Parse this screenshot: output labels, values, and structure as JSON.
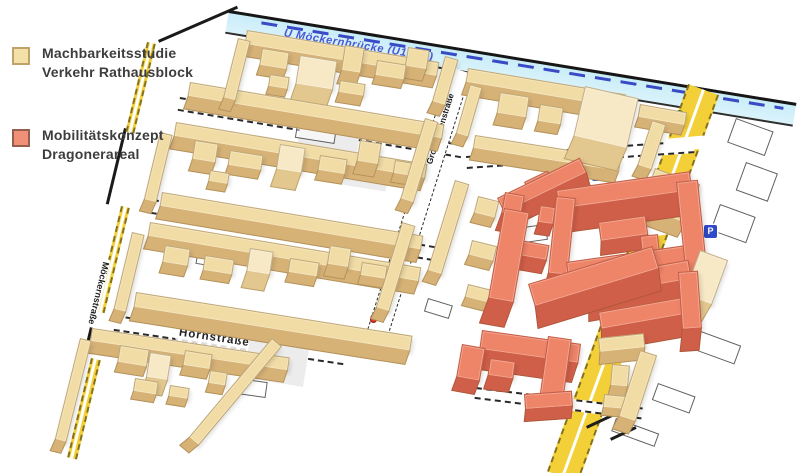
{
  "legend": {
    "items": [
      {
        "swatch_fill": "#f2e2a8",
        "swatch_border": "#c0a36a",
        "lines": [
          "Machbarkeitsstudie",
          "Verkehr Rathausblock"
        ]
      },
      {
        "swatch_fill": "#f09077",
        "swatch_border": "#93604f",
        "lines": [
          "Mobilitätskonzept",
          "Dragonerareal"
        ]
      }
    ]
  },
  "colors": {
    "beige_top": "#f1dca6",
    "beige_side": "#d7b277",
    "beige_light_top": "#f7e9c6",
    "beige_light_side": "#e2c88e",
    "salmon_top": "#ee8468",
    "salmon_side": "#d05f49",
    "canal": "#c9edf8",
    "road_yellow": "#f4d038",
    "ubahn_blue": "#4a57d4",
    "parking_blue": "#2f49c9"
  },
  "map": {
    "canal": {
      "x": 229,
      "y": 10,
      "w": 575,
      "h": 24,
      "r": 9.3,
      "label": "U Möckernbrücke (U1, U3)"
    },
    "edges": [
      {
        "x": 158,
        "y": 40,
        "w": 86,
        "h": 3,
        "r": -23.5
      },
      {
        "x": 124,
        "y": 128,
        "w": 3,
        "h": 78,
        "r": 13.5
      },
      {
        "x": 94,
        "y": 310,
        "w": 3,
        "h": 52,
        "r": 13.5
      }
    ],
    "yellow_roads": [
      {
        "id": "mehringdamm",
        "x": 688,
        "y": 84,
        "w": 33,
        "h": 412,
        "r": 20,
        "label": "Mehringdamm",
        "label_top": 195,
        "label_size": 11
      },
      {
        "id": "moeckernstrasse-n",
        "x": 147,
        "y": 42,
        "w": 9,
        "h": 92,
        "r": 13.5
      },
      {
        "id": "moeckernstrasse-m",
        "x": 121,
        "y": 206,
        "w": 9,
        "h": 108,
        "r": 13.5
      },
      {
        "id": "moeckernstrasse-s",
        "x": 91,
        "y": 358,
        "w": 10,
        "h": 102,
        "r": 13.5
      }
    ],
    "white_roads": [
      {
        "id": "cross-street-1",
        "x": 180,
        "y": 97,
        "w": 287,
        "h": 14,
        "r": 9.5
      },
      {
        "id": "cross-street-2",
        "x": 153,
        "y": 199,
        "w": 296,
        "h": 15,
        "r": 9.5
      },
      {
        "id": "hornstrasse",
        "x": 116,
        "y": 315,
        "w": 232,
        "h": 16,
        "r": 8.5,
        "label": "Hornstraße",
        "label_left": 62,
        "label_size": 11.5
      },
      {
        "id": "obentrautstrasse",
        "x": 466,
        "y": 156,
        "w": 228,
        "h": 13,
        "r": -4
      },
      {
        "id": "south-street",
        "x": 476,
        "y": 387,
        "w": 168,
        "h": 12,
        "r": 7
      },
      {
        "id": "grossbeerenstrasse",
        "x": 450,
        "y": 67,
        "w": 22,
        "h": 300,
        "r": 17.5,
        "vertical": true,
        "vlabels": [
          {
            "label": "Großbeerenstraße",
            "top": 22,
            "size": 8.5
          },
          {
            "label": "Großbeerenstraße",
            "top": 178,
            "size": 8.5
          }
        ]
      }
    ],
    "vlabels": [
      {
        "id": "moeckernstrasse-label",
        "x": 102,
        "y": 258,
        "r": 13.5,
        "label": "Möckernstraße",
        "size": 9
      }
    ],
    "patches": [
      {
        "kind": "patch",
        "x": 664,
        "y": 139,
        "w": 40,
        "h": 13,
        "r": -5
      },
      {
        "kind": "patch",
        "x": 606,
        "y": 294,
        "w": 40,
        "h": 12,
        "r": -10
      },
      {
        "kind": "patch",
        "x": 634,
        "y": 228,
        "w": 36,
        "h": 11,
        "r": -8
      },
      {
        "kind": "gpatch",
        "x": 300,
        "y": 128,
        "w": 60,
        "h": 30,
        "r": 9
      },
      {
        "kind": "gpatch",
        "x": 340,
        "y": 160,
        "w": 50,
        "h": 24,
        "r": 9
      },
      {
        "kind": "gpatch",
        "x": 250,
        "y": 338,
        "w": 60,
        "h": 40,
        "r": 9
      },
      {
        "kind": "gpatch",
        "x": 598,
        "y": 200,
        "w": 40,
        "h": 20,
        "r": -8
      },
      {
        "kind": "green-patch",
        "x": 332,
        "y": 111,
        "w": 14,
        "h": 9,
        "r": 9
      }
    ],
    "footprints": [
      {
        "x": 736,
        "y": 118,
        "w": 40,
        "h": 26,
        "r": 20
      },
      {
        "x": 746,
        "y": 162,
        "w": 34,
        "h": 30,
        "r": 20
      },
      {
        "x": 720,
        "y": 204,
        "w": 38,
        "h": 28,
        "r": 20
      },
      {
        "x": 698,
        "y": 330,
        "w": 46,
        "h": 20,
        "r": 20
      },
      {
        "x": 658,
        "y": 383,
        "w": 40,
        "h": 18,
        "r": 20
      },
      {
        "x": 616,
        "y": 418,
        "w": 46,
        "h": 14,
        "r": 20
      },
      {
        "x": 298,
        "y": 118,
        "w": 40,
        "h": 20,
        "r": 9
      },
      {
        "x": 348,
        "y": 228,
        "w": 36,
        "h": 18,
        "r": 9
      },
      {
        "x": 198,
        "y": 248,
        "w": 30,
        "h": 16,
        "r": 9
      },
      {
        "x": 516,
        "y": 228,
        "w": 30,
        "h": 16,
        "r": -8
      },
      {
        "x": 588,
        "y": 298,
        "w": 28,
        "h": 14,
        "r": -8
      },
      {
        "x": 238,
        "y": 378,
        "w": 30,
        "h": 16,
        "r": 8
      },
      {
        "x": 428,
        "y": 298,
        "w": 26,
        "h": 14,
        "r": 17
      },
      {
        "x": 652,
        "y": 298,
        "w": 30,
        "h": 16,
        "r": -8
      }
    ],
    "fp_lines": [
      {
        "x": 586,
        "y": 426,
        "w": 30,
        "h": 3,
        "r": -25
      },
      {
        "x": 610,
        "y": 438,
        "w": 28,
        "h": 3,
        "r": -25
      }
    ],
    "markers": [
      {
        "type": "p",
        "x": 592,
        "y": 168,
        "label": "P"
      },
      {
        "type": "p",
        "x": 704,
        "y": 225,
        "label": "P"
      },
      {
        "type": "green-dot",
        "x": 675,
        "y": 110
      },
      {
        "type": "red-dot",
        "x": 370,
        "y": 314
      },
      {
        "type": "blue-dot",
        "x": 560,
        "y": 290
      }
    ],
    "buildings": [
      [
        247,
        30,
        195,
        15,
        12,
        9.5,
        "b"
      ],
      [
        238,
        38,
        13,
        62,
        12,
        14,
        "b"
      ],
      [
        190,
        82,
        258,
        15,
        13,
        9.5,
        "b"
      ],
      [
        445,
        56,
        14,
        48,
        12,
        16,
        "b"
      ],
      [
        262,
        48,
        28,
        18,
        10,
        9,
        "b"
      ],
      [
        300,
        55,
        38,
        30,
        22,
        9,
        "bl"
      ],
      [
        345,
        45,
        20,
        26,
        14,
        9,
        "b"
      ],
      [
        377,
        60,
        30,
        16,
        9,
        9,
        "b"
      ],
      [
        408,
        47,
        22,
        20,
        12,
        9,
        "b"
      ],
      [
        270,
        74,
        20,
        13,
        8,
        9,
        "b"
      ],
      [
        340,
        80,
        26,
        13,
        10,
        9,
        "b"
      ],
      [
        468,
        68,
        160,
        15,
        13,
        9.5,
        "b"
      ],
      [
        475,
        135,
        148,
        14,
        12,
        9,
        "b"
      ],
      [
        470,
        84,
        13,
        52,
        11,
        16,
        "b"
      ],
      [
        585,
        86,
        55,
        52,
        24,
        13,
        "bl"
      ],
      [
        500,
        92,
        30,
        22,
        12,
        9,
        "b"
      ],
      [
        540,
        104,
        24,
        18,
        10,
        9,
        "b"
      ],
      [
        640,
        104,
        48,
        14,
        10,
        10,
        "b"
      ],
      [
        652,
        120,
        15,
        48,
        12,
        18,
        "b"
      ],
      [
        655,
        168,
        48,
        42,
        16,
        20,
        "b"
      ],
      [
        176,
        122,
        255,
        15,
        13,
        9.5,
        "b"
      ],
      [
        160,
        132,
        13,
        70,
        12,
        13.5,
        "b"
      ],
      [
        162,
        192,
        265,
        15,
        13,
        9.5,
        "b"
      ],
      [
        425,
        118,
        14,
        85,
        12,
        17,
        "b"
      ],
      [
        195,
        140,
        24,
        20,
        12,
        9,
        "b"
      ],
      [
        230,
        150,
        34,
        16,
        9,
        9,
        "b"
      ],
      [
        280,
        144,
        26,
        26,
        18,
        9,
        "bl"
      ],
      [
        320,
        155,
        28,
        16,
        10,
        9,
        "b"
      ],
      [
        360,
        140,
        22,
        22,
        13,
        9,
        "b"
      ],
      [
        395,
        160,
        24,
        14,
        9,
        9,
        "b"
      ],
      [
        210,
        170,
        20,
        12,
        8,
        9,
        "b"
      ],
      [
        455,
        180,
        15,
        95,
        12,
        17,
        "b"
      ],
      [
        478,
        196,
        22,
        18,
        10,
        14,
        "b"
      ],
      [
        472,
        240,
        26,
        16,
        10,
        14,
        "b"
      ],
      [
        468,
        284,
        24,
        14,
        9,
        14,
        "b"
      ],
      [
        150,
        222,
        275,
        15,
        13,
        9.5,
        "b"
      ],
      [
        132,
        232,
        13,
        80,
        12,
        13.5,
        "b"
      ],
      [
        136,
        292,
        280,
        16,
        14,
        9,
        "b"
      ],
      [
        402,
        222,
        14,
        90,
        12,
        17,
        "b"
      ],
      [
        165,
        245,
        26,
        18,
        11,
        9,
        "b"
      ],
      [
        205,
        255,
        30,
        16,
        9,
        9,
        "b"
      ],
      [
        250,
        248,
        24,
        24,
        17,
        9,
        "bl"
      ],
      [
        290,
        258,
        30,
        15,
        10,
        9,
        "b"
      ],
      [
        330,
        245,
        22,
        20,
        12,
        9,
        "b"
      ],
      [
        362,
        262,
        26,
        14,
        9,
        9,
        "b"
      ],
      [
        92,
        328,
        200,
        14,
        12,
        8.5,
        "b"
      ],
      [
        80,
        338,
        12,
        105,
        12,
        14,
        "b"
      ],
      [
        272,
        338,
        13,
        130,
        12,
        40,
        "b"
      ],
      [
        120,
        345,
        30,
        18,
        10,
        9,
        "b"
      ],
      [
        150,
        352,
        22,
        26,
        16,
        9,
        "bl"
      ],
      [
        185,
        350,
        28,
        16,
        10,
        9,
        "b"
      ],
      [
        135,
        378,
        24,
        14,
        8,
        9,
        "b"
      ],
      [
        170,
        385,
        20,
        12,
        8,
        9,
        "b"
      ],
      [
        210,
        370,
        18,
        14,
        9,
        9,
        "b"
      ],
      [
        598,
        338,
        46,
        15,
        12,
        -6,
        "b"
      ],
      [
        640,
        350,
        18,
        70,
        14,
        18,
        "b"
      ],
      [
        612,
        364,
        18,
        22,
        10,
        5,
        "b"
      ],
      [
        604,
        394,
        22,
        14,
        8,
        5,
        "b"
      ],
      [
        700,
        250,
        30,
        48,
        22,
        20,
        "bl"
      ],
      [
        497,
        198,
        92,
        17,
        16,
        -26,
        "s"
      ],
      [
        505,
        192,
        20,
        22,
        18,
        10,
        "s"
      ],
      [
        524,
        182,
        26,
        13,
        12,
        -26,
        "s"
      ],
      [
        556,
        190,
        135,
        20,
        24,
        -8,
        "s"
      ],
      [
        676,
        182,
        22,
        100,
        24,
        -6,
        "s"
      ],
      [
        566,
        262,
        130,
        20,
        22,
        -8,
        "s"
      ],
      [
        556,
        196,
        20,
        78,
        22,
        6,
        "s"
      ],
      [
        598,
        222,
        48,
        20,
        14,
        -8,
        "s"
      ],
      [
        640,
        236,
        18,
        26,
        12,
        -6,
        "s"
      ],
      [
        504,
        208,
        26,
        92,
        26,
        10,
        "s"
      ],
      [
        528,
        284,
        130,
        24,
        22,
        -17,
        "s"
      ],
      [
        585,
        278,
        105,
        20,
        24,
        -10,
        "s"
      ],
      [
        598,
        312,
        98,
        18,
        22,
        -10,
        "s"
      ],
      [
        678,
        272,
        20,
        58,
        22,
        -4,
        "s"
      ],
      [
        482,
        330,
        100,
        20,
        20,
        8,
        "s"
      ],
      [
        548,
        336,
        24,
        62,
        20,
        8,
        "s"
      ],
      [
        490,
        358,
        26,
        18,
        14,
        8,
        "s"
      ],
      [
        462,
        344,
        24,
        34,
        14,
        10,
        "s"
      ],
      [
        524,
        394,
        48,
        16,
        12,
        -4,
        "s"
      ],
      [
        520,
        240,
        30,
        16,
        14,
        10,
        "s"
      ],
      [
        540,
        205,
        16,
        18,
        12,
        8,
        "s"
      ]
    ]
  }
}
